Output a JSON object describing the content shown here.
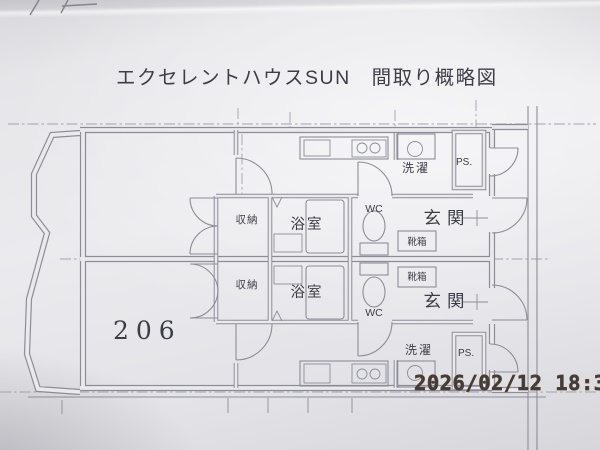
{
  "document": {
    "title": "エクセレントハウスSUN　間取り概略図",
    "room_number_stamp": "206"
  },
  "photo": {
    "timestamp": "2026/02/12 18:39"
  },
  "floor_plan": {
    "rooms": {
      "closet": "収納",
      "bathroom": "浴室",
      "toilet": "WC",
      "entrance": "玄関",
      "shoe_cabinet": "靴箱",
      "laundry": "洗濯",
      "pipe_space": "PS."
    }
  },
  "colors": {
    "timestamp_orange": "#f2a41f",
    "stamp_green": "#2f7a4e",
    "plan_line_gray": "#8d8d99"
  }
}
